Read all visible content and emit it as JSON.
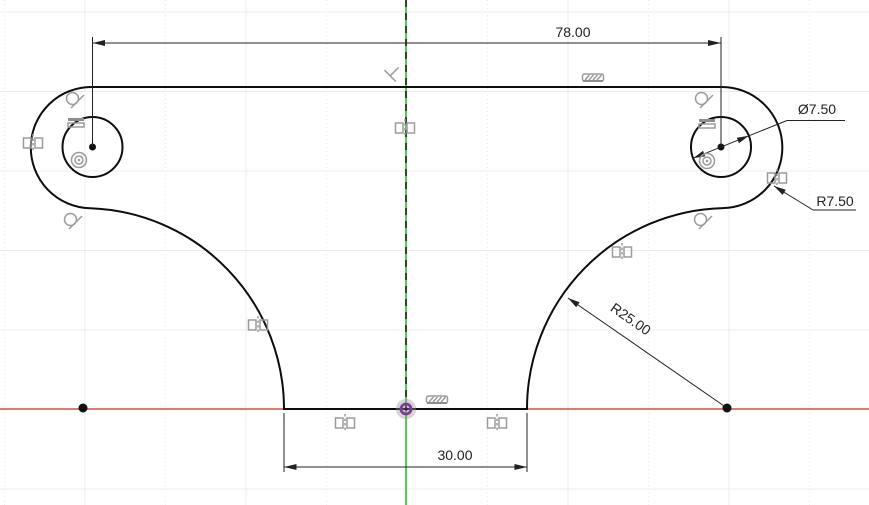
{
  "app": {
    "type": "cad-sketch-canvas",
    "description": "2D sketch of a symmetric T-shaped bracket profile with two holes, shown on a sketch grid with X (red) and Y (green) origin axes"
  },
  "dimensions": {
    "top_width": {
      "label": "78.00",
      "kind": "linear"
    },
    "hole_diameter": {
      "label": "Ø7.50",
      "kind": "diameter"
    },
    "end_radius": {
      "label": "R7.50",
      "kind": "radius"
    },
    "side_radius": {
      "label": "R25.00",
      "kind": "radius"
    },
    "bottom_width": {
      "label": "30.00",
      "kind": "linear"
    }
  },
  "constraints": {
    "tangent_count": 4,
    "horizontal_count": 2,
    "concentric_count": 2,
    "symmetry_count": 7,
    "collinear_count": 2,
    "perpendicular_count": 1
  },
  "colors": {
    "background": "#ffffff",
    "grid": "#ececec",
    "profile_fill": "#eaf2f8",
    "profile_fill_dot": "#d3e3ee",
    "outline": "#0d0d0d",
    "axis_x_red": "#e07a6e",
    "axis_y_green": "#3ecb3e",
    "origin_purple": "#7d3c98",
    "dimension_text": "#222222",
    "constraint_icon": "#9b9b9b"
  }
}
